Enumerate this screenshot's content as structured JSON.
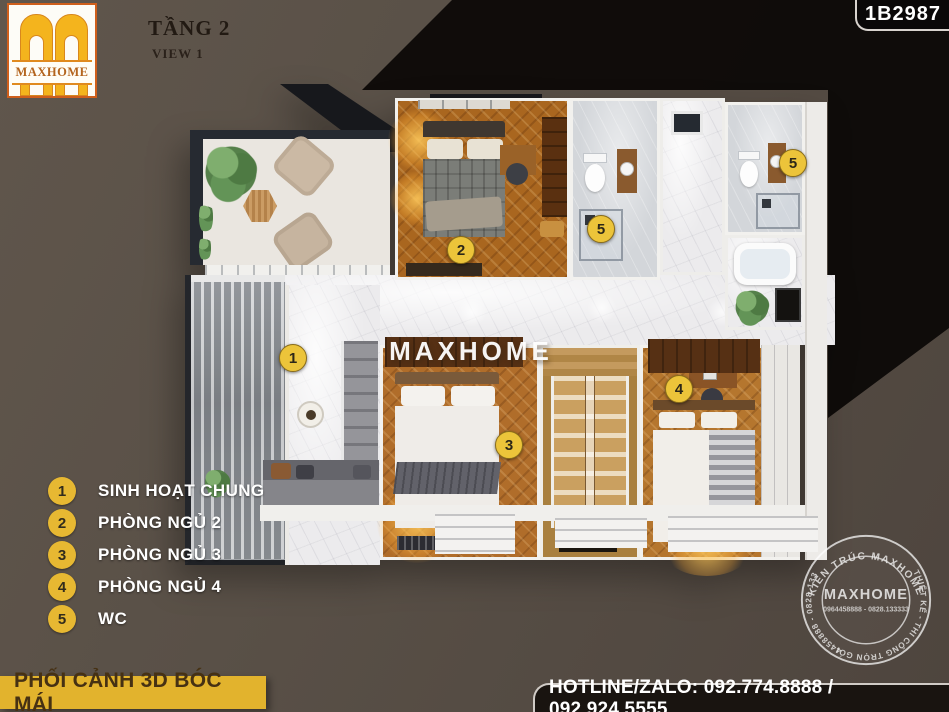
{
  "header": {
    "logo_text": "MAXHOME",
    "title": "TẦNG 2",
    "subtitle": "VIEW 1",
    "code": "1B2987"
  },
  "legend": {
    "items": [
      {
        "num": "1",
        "label": "SINH HOẠT CHUNG"
      },
      {
        "num": "2",
        "label": "PHÒNG NGỦ 2"
      },
      {
        "num": "3",
        "label": "PHÒNG NGỦ 3"
      },
      {
        "num": "4",
        "label": "PHÒNG NGỦ 4"
      },
      {
        "num": "5",
        "label": "WC"
      }
    ]
  },
  "plan": {
    "watermark": "MAXHOME",
    "markers": [
      {
        "num": "1"
      },
      {
        "num": "2"
      },
      {
        "num": "3"
      },
      {
        "num": "4"
      },
      {
        "num": "5"
      },
      {
        "num": "5"
      }
    ]
  },
  "stamp": {
    "arc_top": "KIẾN TRÚC MAXHOME",
    "arc_bottom": "THIẾT KẾ - THI CÔNG TRỌN GÓI",
    "arc_left": "0964458888 - 0828.133333",
    "center_name": "MAXHOME",
    "center_phone": "0964458888 - 0828.133333"
  },
  "footer": {
    "caption": "PHỐI CẢNH 3D BÓC MÁI",
    "hotline": "HOTLINE/ZALO: 092.774.8888 / 092.924.5555"
  },
  "colors": {
    "accent_yellow": "#e7b832",
    "background": "#595047",
    "shadow": "#0d0a08"
  }
}
